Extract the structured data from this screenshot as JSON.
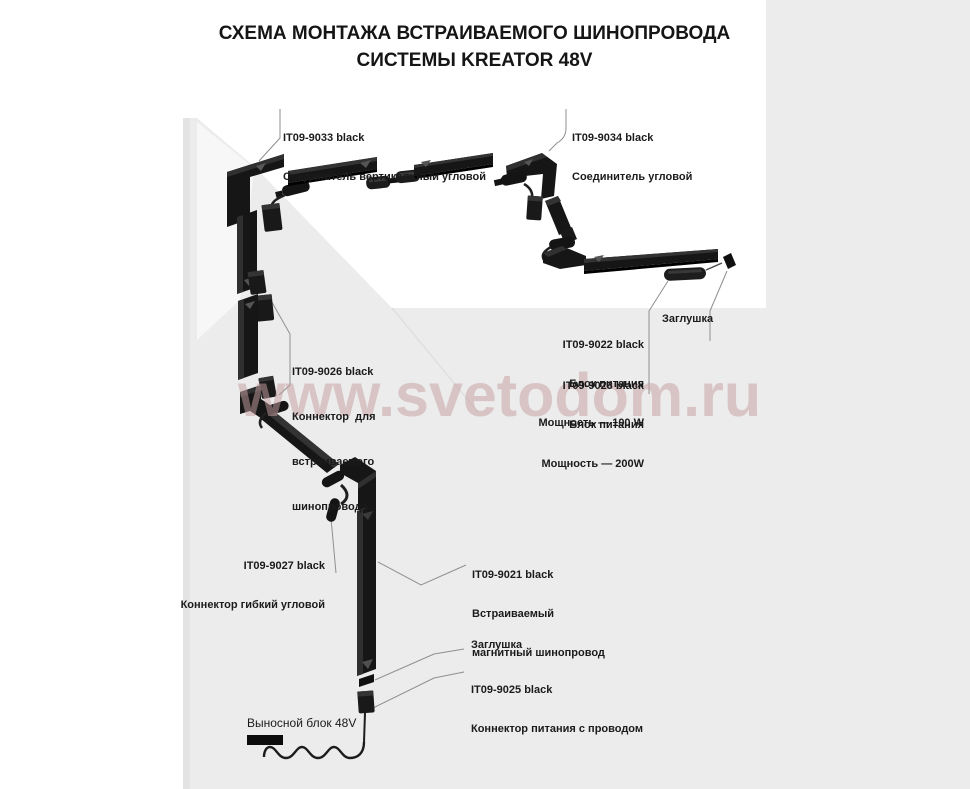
{
  "title": {
    "line1": "СХЕМА МОНТАЖА ВСТРАИВАЕМОГО ШИНОПРОВОДА",
    "line2": "СИСТЕМЫ KREATOR 48V"
  },
  "watermark": "www.svetodom.ru",
  "labels": {
    "l9033": {
      "code": "IT09-9033 black",
      "desc": "Соединитель вертикальный угловой"
    },
    "l9034": {
      "code": "IT09-9034 black",
      "desc": "Соединитель угловой"
    },
    "l9026": {
      "code": "IT09-9026 black",
      "line1": "Коннектор  для",
      "line2": "встраиваемого",
      "line3": "шинопровода"
    },
    "l9022": {
      "code": "IT09-9022 black",
      "line1": "Блок питания",
      "line2": "Мощность — 100 W"
    },
    "l9023": {
      "code": "IT09-9023 black",
      "line1": "Блок питания",
      "line2": "Мощность — 200W"
    },
    "cap_top": "Заглушка",
    "l9027": {
      "code": "IT09-9027 black",
      "desc": "Коннектор гибкий угловой"
    },
    "l9021": {
      "code": "IT09-9021 black",
      "line1": "Встраиваемый",
      "line2": "магнитный шинопровод"
    },
    "cap_bottom": "Заглушка",
    "l9025": {
      "code": "IT09-9025 black",
      "desc": "Коннектор питания с проводом"
    },
    "external_unit": "Выносной блок 48V"
  },
  "colors": {
    "wall": "#ececec",
    "part_black": "#161616",
    "watermark": "#c6a0a0",
    "leader": "#8f8f8f"
  }
}
